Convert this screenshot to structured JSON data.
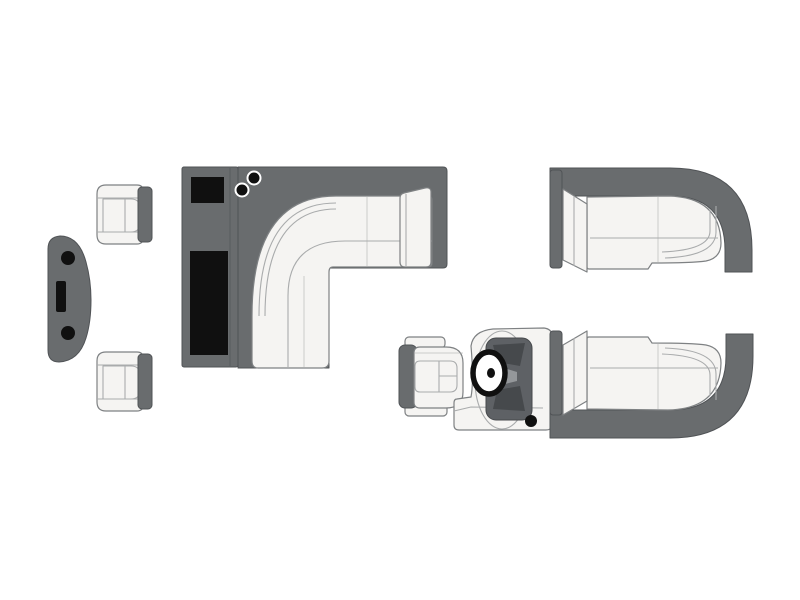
{
  "figure": {
    "type": "pontoon-boat-floorplan",
    "orientation": "top-down",
    "background": "#ffffff"
  },
  "palette": {
    "paper": "#ffffff",
    "dark": "#696c6e",
    "edge": "#505356",
    "ink": "#101010",
    "cushion": "#f5f4f2",
    "outline": "#7e8183",
    "seam": "#a9abac",
    "dash": "#5e6165",
    "dashdark": "#46494c",
    "dashlight": "#94979a"
  },
  "elements": [
    {
      "name": "bow-platform",
      "features": [
        "cleat-dot-top",
        "cleat-dot-bottom",
        "gate-slot"
      ]
    },
    {
      "name": "port-chair-fore",
      "features": [
        "seat-cushion",
        "backrest-bar"
      ]
    },
    {
      "name": "port-chair-aft",
      "features": [
        "seat-cushion",
        "backrest-bar"
      ]
    },
    {
      "name": "galley-console",
      "features": [
        "black-counter-small",
        "black-counter-long",
        "cupholder-1",
        "cupholder-2"
      ]
    },
    {
      "name": "port-l-lounge",
      "features": [
        "corner-piping",
        "armrest",
        "backrest-band"
      ]
    },
    {
      "name": "helm-seat",
      "features": [
        "armrest-top",
        "armrest-bottom",
        "backrest-bar"
      ]
    },
    {
      "name": "helm-console",
      "features": [
        "dashboard",
        "steering-wheel",
        "throttle-dot"
      ]
    },
    {
      "name": "starboard-bow-lounge",
      "features": [
        "wrap-backrest",
        "armrest",
        "corner-piping"
      ]
    },
    {
      "name": "starboard-stern-lounge",
      "features": [
        "wrap-backrest",
        "armrest",
        "corner-piping"
      ]
    }
  ]
}
